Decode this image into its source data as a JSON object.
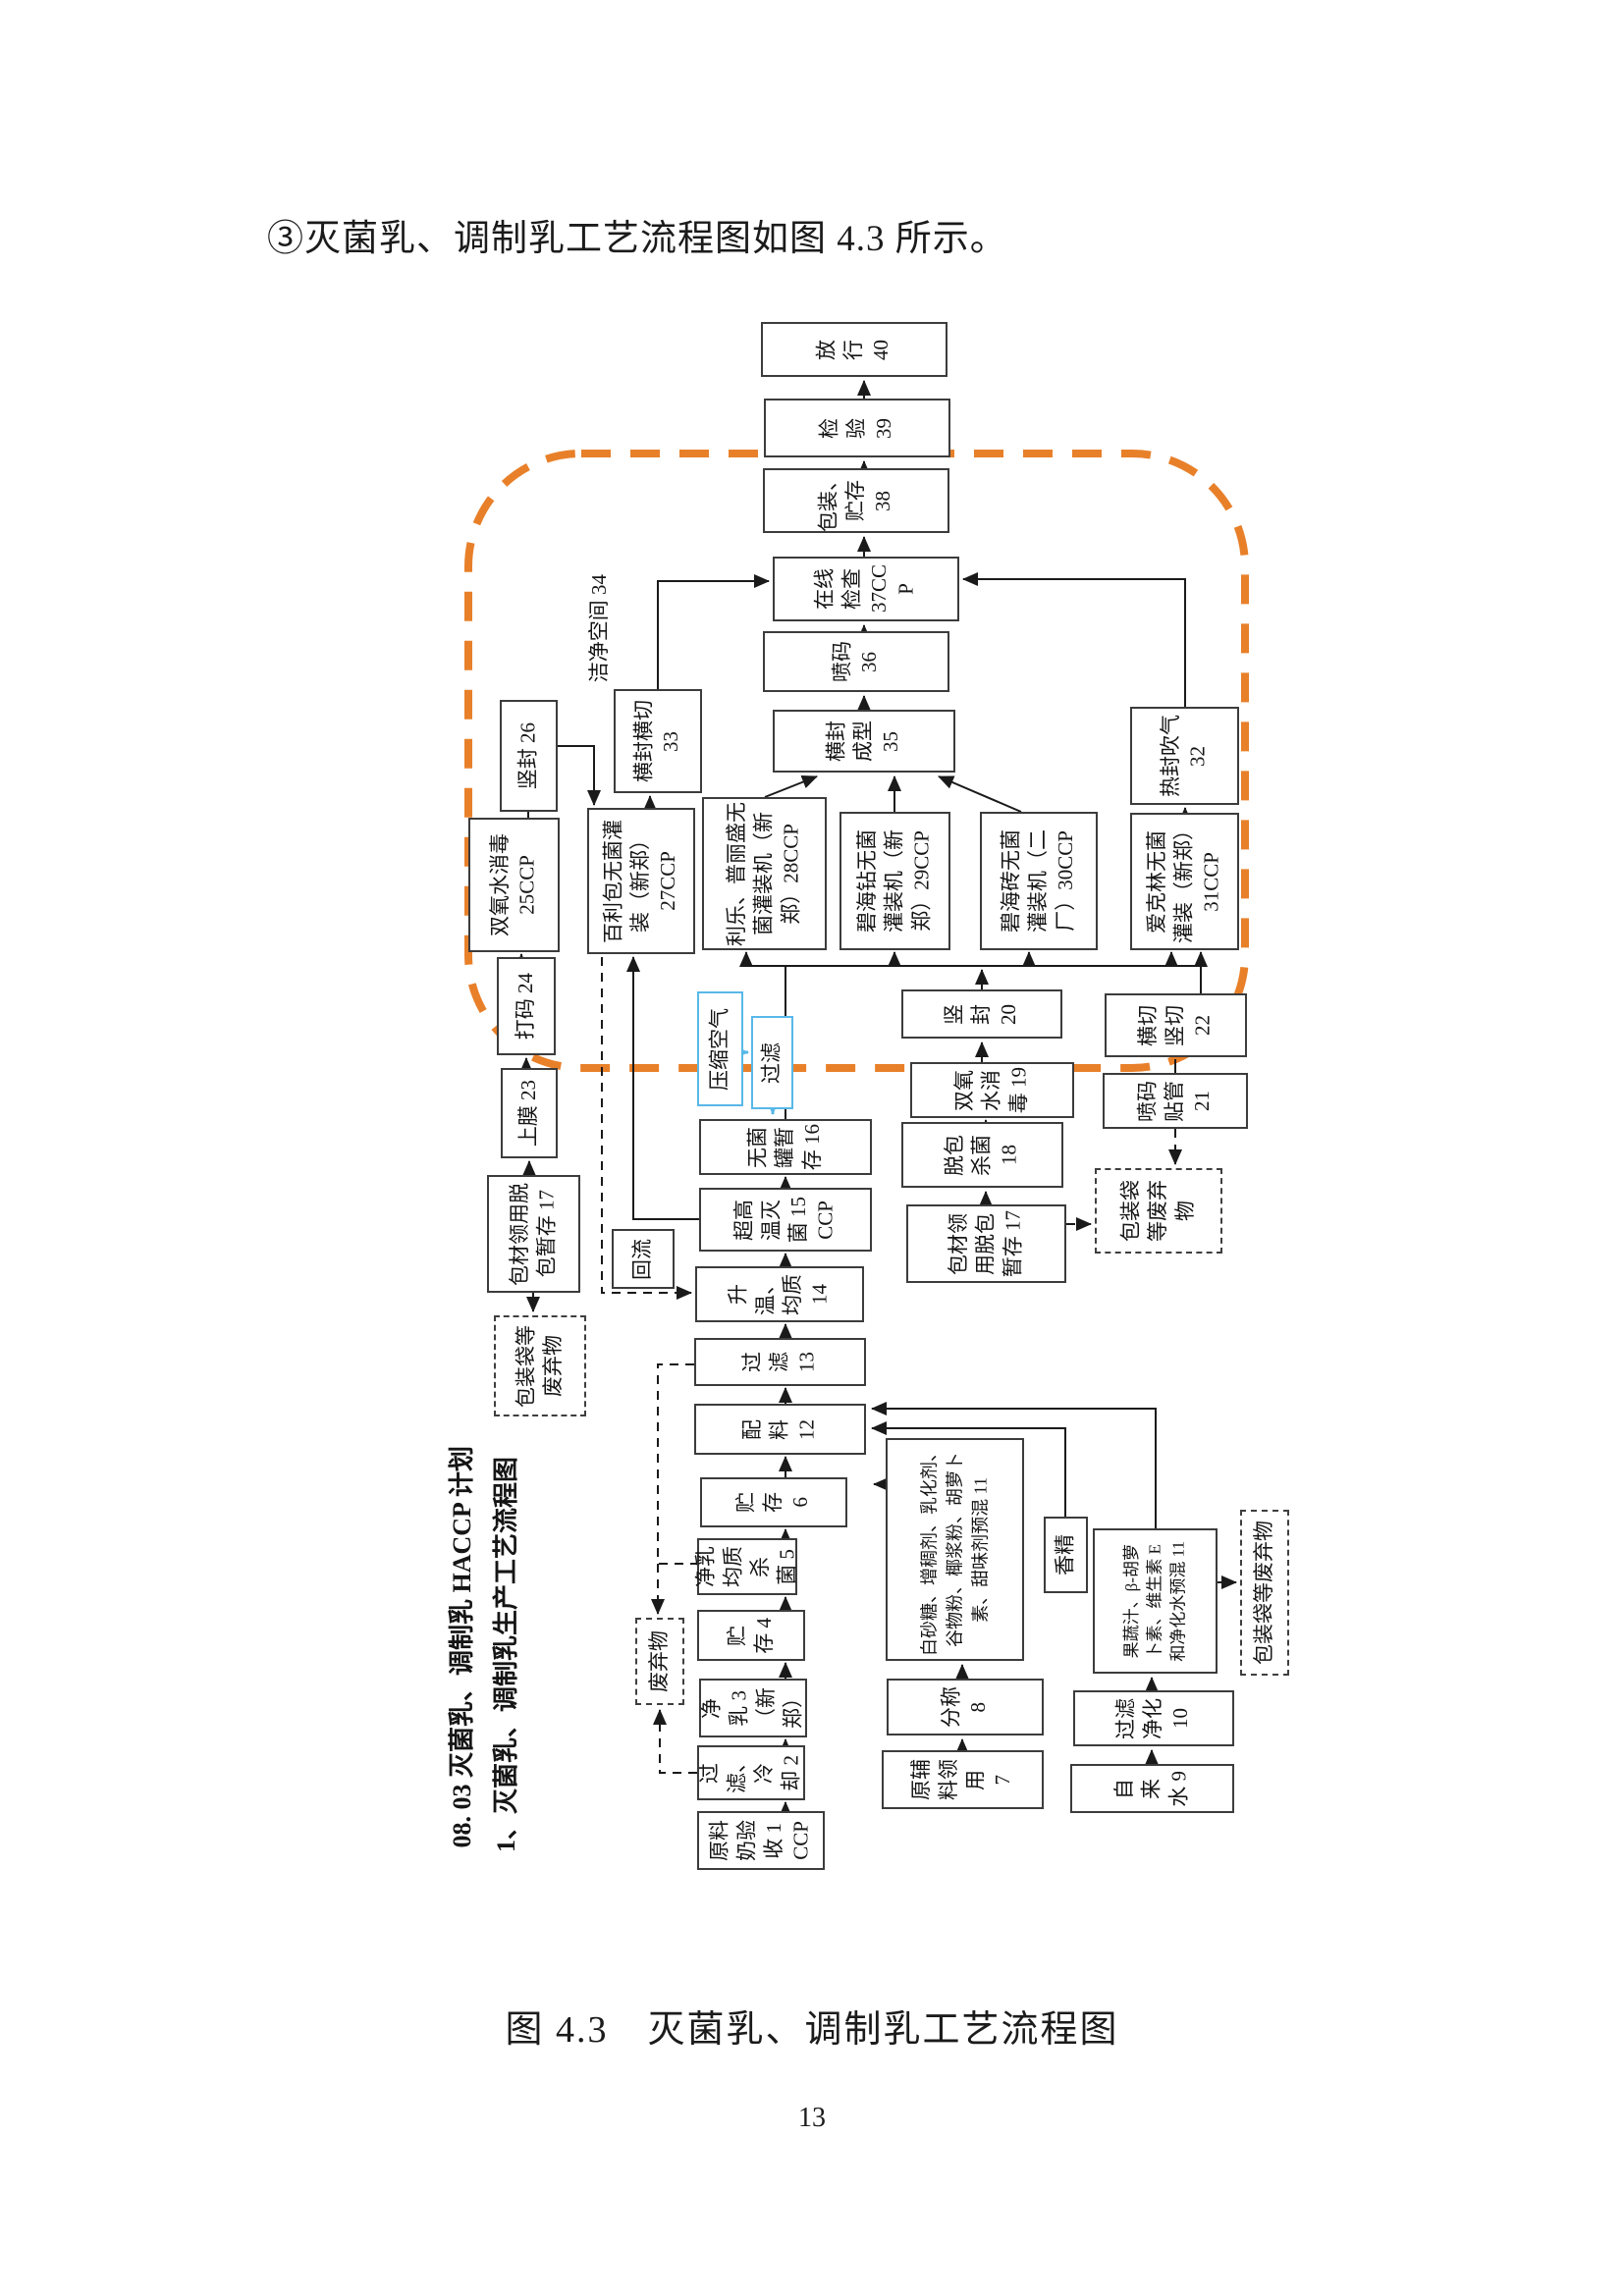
{
  "page": {
    "heading": "③灭菌乳、调制乳工艺流程图如图 4.3 所示。",
    "caption": "图 4.3　灭菌乳、调制乳工艺流程图",
    "page_number": "13"
  },
  "diagram": {
    "side_titles": {
      "haccp_plan": "08. 03 灭菌乳、调制乳 HACCP 计划",
      "flow_title": "1、灭菌乳、调制乳生产工艺流程图"
    },
    "clean_room_label": "洁净空间 34",
    "colors": {
      "boundary_orange": "#e8802a",
      "utility_blue": "#58b8e8"
    },
    "nodes": {
      "step40": {
        "label": "放\n行\n40"
      },
      "step39": {
        "label": "检\n验\n39"
      },
      "step38": {
        "label": "包装、\n贮存\n38"
      },
      "step37": {
        "label": "在线\n检查\n37CC\nP"
      },
      "step36": {
        "label": "喷码\n36"
      },
      "step35": {
        "label": "横封\n成型\n35"
      },
      "step33": {
        "label": "横封横切\n33"
      },
      "step32": {
        "label": "热封吹气\n32"
      },
      "step31": {
        "label": "爱克林无菌\n灌装（新郑）\n31CCP"
      },
      "step30": {
        "label": "碧海砖无菌\n灌装机（二\n厂）30CCP"
      },
      "step29": {
        "label": "碧海钻无菌\n灌装机（新\n郑）29CCP"
      },
      "step28": {
        "label": "利乐、普丽盛无\n菌灌装机（新\n郑）28CCP"
      },
      "step27": {
        "label": "百利包无菌灌\n装（新郑）\n27CCP"
      },
      "step26": {
        "label": "竖封 26"
      },
      "step25": {
        "label": "双氧水消毒\n25CCP"
      },
      "step24": {
        "label": "打码 24"
      },
      "step23": {
        "label": "上膜 23"
      },
      "step22": {
        "label": "横切\n竖切\n22"
      },
      "step21": {
        "label": "喷码\n贴管\n21"
      },
      "step20": {
        "label": "竖\n封\n20"
      },
      "step19": {
        "label": "双氧\n水消\n毒 19"
      },
      "step18": {
        "label": "脱包\n杀菌\n18"
      },
      "step17_left": {
        "label": "包材领用脱\n包暂存 17"
      },
      "step17_right": {
        "label": "包材领\n用脱包\n暂存 17"
      },
      "step16": {
        "label": "无菌\n罐暂\n存 16"
      },
      "step15": {
        "label": "超高\n温灭\n菌 15\nCCP"
      },
      "step14": {
        "label": "升\n温、\n均质\n14"
      },
      "step13": {
        "label": "过\n滤\n13"
      },
      "step12": {
        "label": "配\n料\n12"
      },
      "step11_dry": {
        "label": "白砂糖、增稠剂、乳化剂、\n谷物粉、椰浆粉、胡萝卜\n素、甜味剂预混 11"
      },
      "step11_juice": {
        "label": "果蔬汁、β-胡萝\n卜素、维生素 E\n和净化水预混 11"
      },
      "step10": {
        "label": "过滤\n净化\n10"
      },
      "step9": {
        "label": "自\n来\n水 9"
      },
      "step8": {
        "label": "分称\n8"
      },
      "step7": {
        "label": "原辅\n料领\n用\n7"
      },
      "step6": {
        "label": "贮\n存\n6"
      },
      "step5": {
        "label": "净乳\n均质\n杀\n菌 5"
      },
      "step4": {
        "label": "贮\n存 4"
      },
      "step3": {
        "label": "净\n乳 3\n（新\n郑）"
      },
      "step2": {
        "label": "过\n滤、\n冷\n却 2"
      },
      "step1": {
        "label": "原料\n奶验\n收 1\nCCP"
      },
      "reflux": {
        "label": "回流"
      },
      "essence": {
        "label": "香精"
      },
      "compressed_air": {
        "label": "压缩空气"
      },
      "air_filter": {
        "label": "过滤"
      },
      "waste_left": {
        "label": "包装袋等\n废弃物"
      },
      "waste_middle": {
        "label": "废弃物"
      },
      "waste_right": {
        "label": "包装袋\n等废弃\n物"
      },
      "waste_bottom_right": {
        "label": "包装袋等废弃物"
      }
    }
  }
}
